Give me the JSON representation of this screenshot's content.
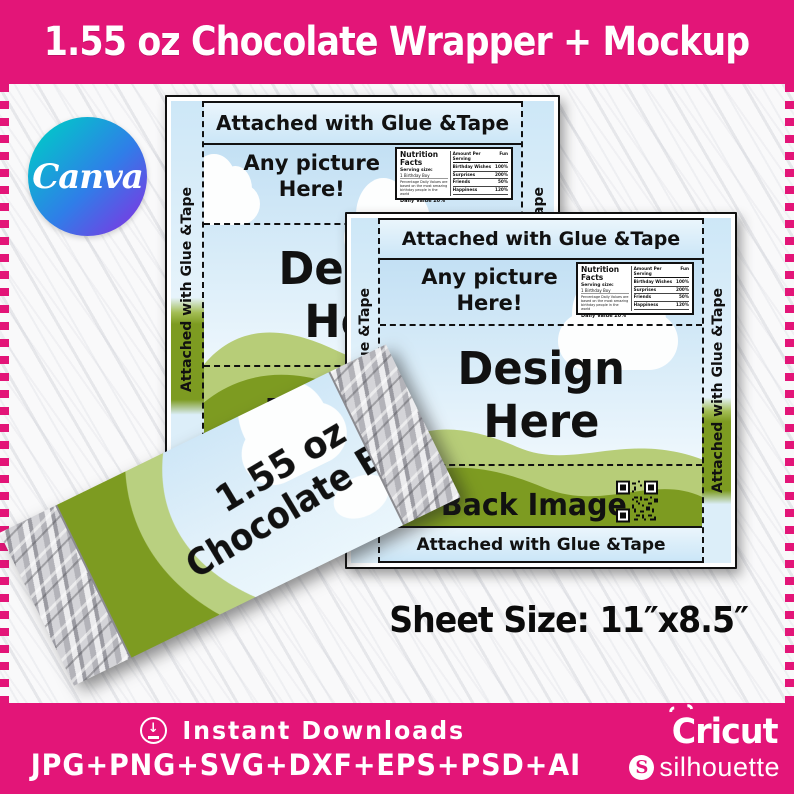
{
  "title_banner": {
    "text": "1.55 oz Chocolate Wrapper + Mockup"
  },
  "canva_badge": {
    "label": "Canva"
  },
  "wrapper": {
    "glue_strip_label": "Attached with Glue &Tape",
    "side_flap_label": "Attached with Glue &Tape",
    "front_panel": {
      "line1": "Any picture",
      "line2": "Here!"
    },
    "design_panel": {
      "line1": "Design",
      "line2": "Here"
    },
    "back_panel_label": "Back Image",
    "nutrition": {
      "title": "Nutrition Facts",
      "serving_label": "Serving size:",
      "serving_value": "1 Birthday Boy",
      "footnote": "Percentage Daily Values are based on the most amazing birthday people in the world",
      "daily_value_label": "Daily Value",
      "daily_value": "20%",
      "amount_header": "Amount Per Serving",
      "fun_header": "Fun",
      "rows": [
        {
          "name": "Birthday Wishes",
          "value": "100%"
        },
        {
          "name": "Surprises",
          "value": "200%"
        },
        {
          "name": "Friends",
          "value": "50%"
        },
        {
          "name": "Happiness",
          "value": "120%"
        }
      ]
    }
  },
  "mockup_bar": {
    "line1": "1.55 oz",
    "line2": "Chocolate Bar"
  },
  "sheet_size_label": "Sheet Size: 11″x8.5″",
  "footer": {
    "download_glyph": "↓",
    "instant_downloads": "Instant Downloads",
    "formats": "JPG+PNG+SVG+DXF+EPS+PSD+AI",
    "cricut": "Cricut",
    "silhouette_initial": "S",
    "silhouette": "silhouette"
  },
  "colors": {
    "brand_pink": "#e31578",
    "sky_blue": "#cde7f7",
    "hill_light": "#b7cd78",
    "hill_dark": "#7d9b21",
    "foil_gray": "#c9c9ce"
  }
}
